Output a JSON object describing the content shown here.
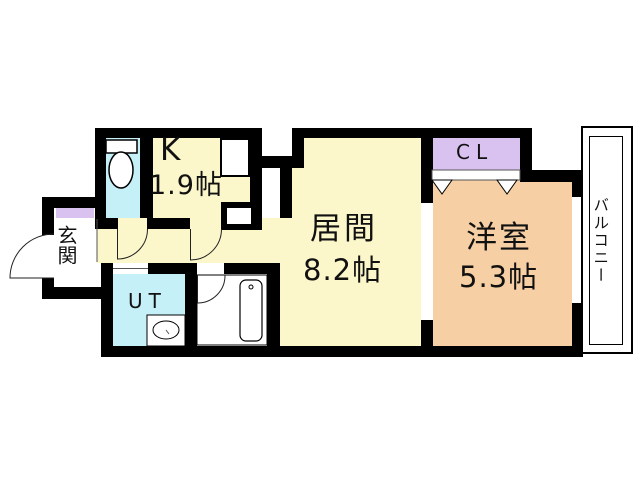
{
  "floorplan": {
    "rooms": {
      "kitchen": {
        "label": "K",
        "size": "1.9帖"
      },
      "living": {
        "label": "居間",
        "size": "8.2帖"
      },
      "western": {
        "label": "洋室",
        "size": "5.3帖"
      },
      "closet": {
        "label": "CL"
      },
      "entrance": {
        "label": "玄関"
      },
      "utility": {
        "label": "UT"
      },
      "balcony": {
        "label": "バルコニー"
      }
    },
    "colors": {
      "room_yellow": "#FBF7CB",
      "room_cyan": "#C6F0F7",
      "room_purple": "#D9C2F0",
      "room_peach": "#F6CFA4",
      "wall": "#000000",
      "background": "#FFFFFF"
    }
  }
}
